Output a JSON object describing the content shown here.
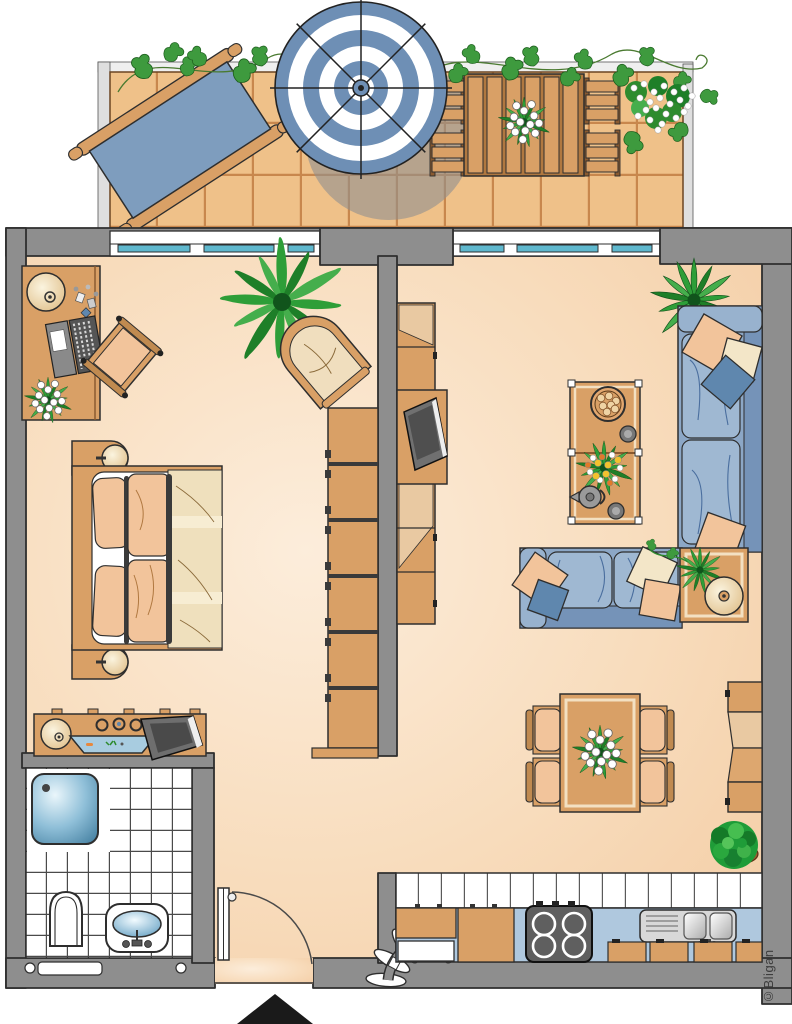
{
  "copyright": "©Bligan",
  "palette": {
    "wall": "#8E8E8E",
    "outline": "#2E2E2E",
    "floor": "#F8DCBC",
    "terrace_tile": "#EFC189",
    "tile_joint": "#C8874D",
    "wood": "#D9A066",
    "wood_dark": "#B07840",
    "wood_light": "#E9C9A2",
    "sofa_blue": "#8CA7C6",
    "sofa_blue_dark": "#7593B8",
    "pillow_peach": "#F2C49B",
    "pillow_cream": "#F3E6C8",
    "pillow_blue": "#5F87AE",
    "window_glass": "#5FB8CE",
    "counter_blue": "#AFC8DE",
    "shower_blue": "#6FA8C6",
    "stove_gray": "#5F5F5F",
    "plant_green": "#2E9E38",
    "plant_dark": "#1E7F28",
    "entrance_arrow": "#1A1A1A"
  },
  "floorplan": {
    "type": "apartment-top-view",
    "rooms": [
      {
        "name": "terrace",
        "objects": [
          "sun-lounger",
          "parasol",
          "wooden-dining-set",
          "table-bouquet",
          "ivy-garland",
          "white-flowering-plant"
        ]
      },
      {
        "name": "bedroom",
        "objects": [
          "desk",
          "desk-lamp",
          "laptop",
          "desk-flowers",
          "desk-chair",
          "palm-plant",
          "wicker-chair",
          "double-bed",
          "nightstand-top",
          "nightstand-bottom",
          "wardrobe",
          "dresser",
          "aquarium",
          "tv"
        ]
      },
      {
        "name": "living-room",
        "objects": [
          "media-wall-unit",
          "tv",
          "corner-plant",
          "corner-sofa",
          "cushions",
          "side-table",
          "decor-disc",
          "coffee-table",
          "cookie-bowl",
          "teapot",
          "cups",
          "flower-bouquet",
          "dining-table",
          "dining-chairs",
          "wall-cabinet",
          "round-bush-plant"
        ]
      },
      {
        "name": "bathroom",
        "objects": [
          "shower-tray",
          "toilet",
          "washbasin",
          "radiator"
        ]
      },
      {
        "name": "kitchen",
        "objects": [
          "tile-backsplash",
          "countertop",
          "cutting-boards",
          "dishwasher-front",
          "stove",
          "double-sink",
          "cabinet-fronts"
        ]
      },
      {
        "name": "hall",
        "objects": [
          "entrance-door",
          "door-swing-arc",
          "fan-decoration"
        ]
      }
    ],
    "entrance_marker": "black-triangle-arrow"
  }
}
